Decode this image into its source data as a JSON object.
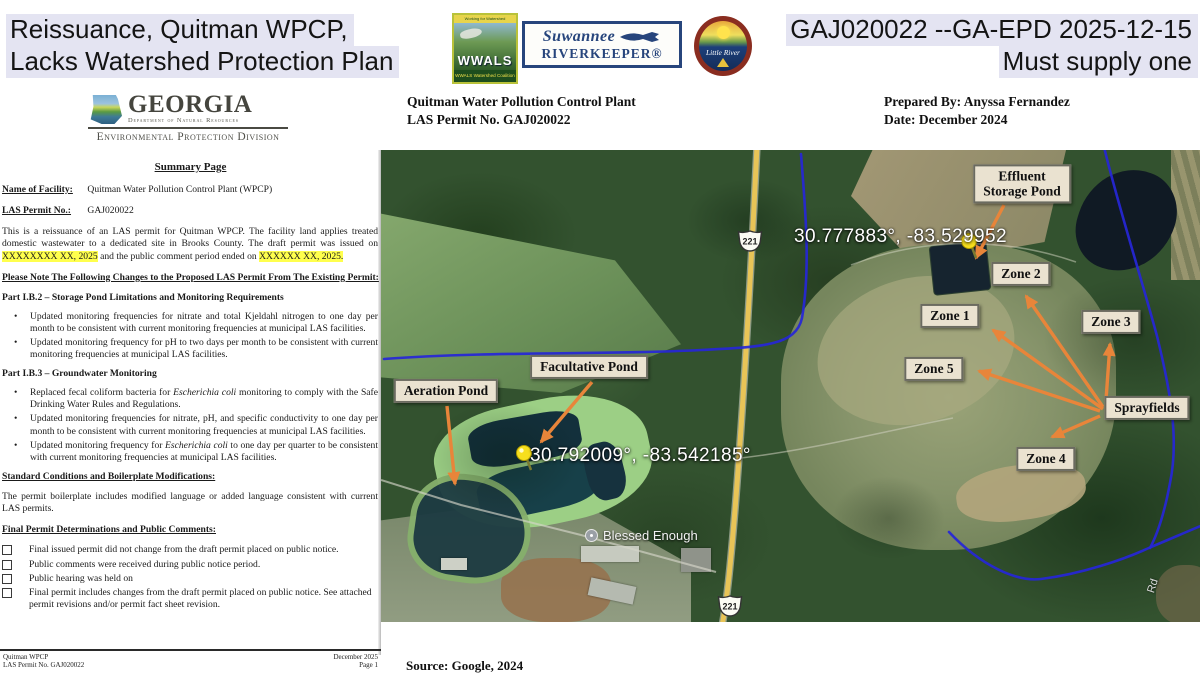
{
  "banner": {
    "title_line1": "Reissuance, Quitman WPCP,",
    "title_line2": "Lacks Watershed Protection Plan",
    "right_line1": "GAJ020022 --GA-EPD 2025-12-15",
    "right_line2": "Must supply one"
  },
  "logos": {
    "wwals": {
      "top_text": "Working for Watershed Conservation",
      "name": "WWALS",
      "subtitle": "WWALS Watershed Coalition"
    },
    "riverkeeper": {
      "line1": "Suwannee",
      "line2": "RIVERKEEPER®"
    },
    "little_river": {
      "name": "Little River"
    }
  },
  "doc_header": {
    "left_line1": "Quitman Water Pollution Control Plant",
    "left_line2": "LAS Permit No. GAJ020022",
    "right_line1": "Prepared By: Anyssa Fernandez",
    "right_line2": "Date: December 2024"
  },
  "agency": {
    "name": "GEORGIA",
    "dept": "Department of Natural Resources",
    "division": "Environmental Protection Division"
  },
  "document": {
    "title": "Summary Page",
    "facility_label": "Name of Facility:",
    "facility_value": "Quitman Water Pollution Control Plant (WPCP)",
    "permit_label": "LAS Permit No.:",
    "permit_value": "GAJ020022",
    "intro_pre": "This is a reissuance of an LAS permit for Quitman WPCP. The facility land applies treated domestic wastewater to a dedicated site in Brooks County. The draft permit was issued on ",
    "intro_hl1": "XXXXXXXX XX, 2025",
    "intro_mid": " and the public comment period ended on ",
    "intro_hl2": "XXXXXX XX, 2025.",
    "changes_heading": "Please Note The Following Changes to the Proposed LAS Permit From The Existing Permit:",
    "part_ib2_heading": "Part I.B.2 – Storage Pond Limitations and Monitoring Requirements",
    "part_ib2_bullets": [
      "Updated monitoring frequencies for nitrate and total Kjeldahl nitrogen to one day per month to be consistent with current monitoring frequencies at municipal LAS facilities.",
      "Updated monitoring frequency for pH to two days per month to be consistent with current monitoring frequencies at municipal LAS facilities."
    ],
    "part_ib3_heading": "Part I.B.3 – Groundwater Monitoring",
    "gw_b1": {
      "pre": "Replaced fecal coliform bacteria for ",
      "it": "Escherichia coli",
      "post": " monitoring to comply with the Safe Drinking Water Rules and Regulations."
    },
    "gw_b2": "Updated monitoring frequencies for nitrate, pH, and specific conductivity to one day per month to be consistent with current monitoring frequencies at municipal LAS facilities.",
    "gw_b3": {
      "pre": "Updated monitoring frequency for ",
      "it": "Escherichia coli",
      "post": " to one day per quarter to be consistent with current monitoring frequencies at municipal LAS facilities."
    },
    "standard_heading": "Standard Conditions and Boilerplate Modifications:",
    "standard_text": "The permit boilerplate includes modified language or added language consistent with current LAS permits.",
    "final_heading": "Final Permit Determinations and Public Comments:",
    "checkboxes": [
      "Final issued permit did not change from the draft permit placed on public notice.",
      "Public comments were received during public notice period.",
      "Public hearing was held on",
      "Final permit includes changes from the draft permit placed on public notice. See attached permit revisions and/or permit fact sheet revision."
    ],
    "footer": {
      "left1": "Quitman WPCP",
      "left2": "LAS Permit No. GAJ020022",
      "right1": "December 2025",
      "right2": "Page 1"
    }
  },
  "map": {
    "labels": {
      "effluent_line1": "Effluent",
      "effluent_line2": "Storage Pond",
      "zone1": "Zone 1",
      "zone2": "Zone 2",
      "zone3": "Zone 3",
      "zone4": "Zone 4",
      "zone5": "Zone 5",
      "facultative": "Facultative Pond",
      "aeration": "Aeration Pond",
      "sprayfields": "Sprayfields"
    },
    "coord_effluent": "30.777883°, -83.529952",
    "coord_facultative": "30.792009°, -83.542185°",
    "place": "Blessed Enough",
    "route_shield": "221",
    "road_label": "Rd",
    "colors": {
      "arrow_orange": "#e8853a",
      "stream_blue": "#2626d8",
      "road_yellow": "#e8c457",
      "label_bg": "#eae2d0",
      "title_highlight": "#e4e4f2",
      "date_highlight": "#ffff4d"
    }
  },
  "source_caption": "Source: Google, 2024"
}
